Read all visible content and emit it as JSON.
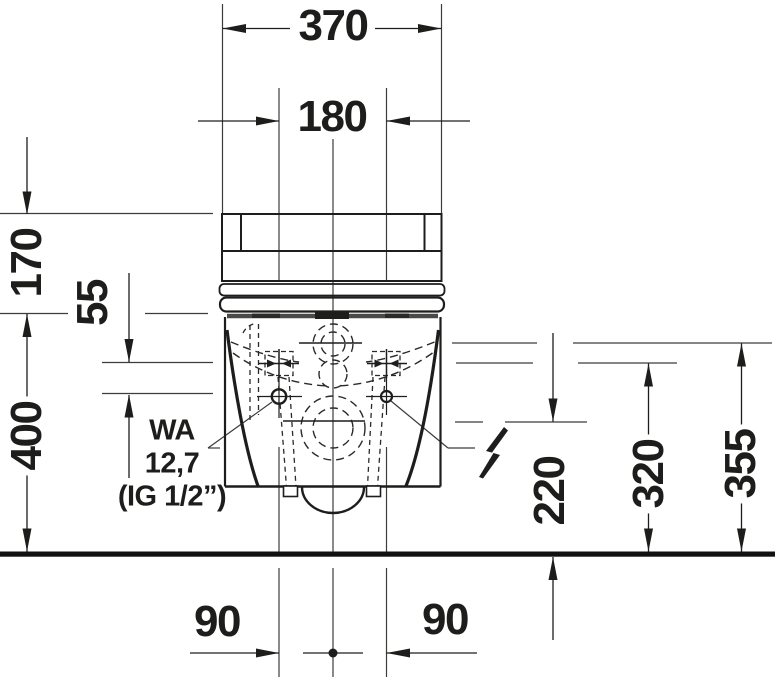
{
  "drawing": {
    "title": "Wall-hung toilet with cistern — front elevation dimension drawing",
    "units": "mm",
    "labels": {
      "d370": "370",
      "d180": "180",
      "d170": "170",
      "d55": "55",
      "d400": "400",
      "d320": "320",
      "d355": "355",
      "d220": "220",
      "d90l": "90",
      "d90r": "90",
      "wa1": "WA",
      "wa2": "12,7",
      "wa3": "(IG 1/2”)"
    },
    "icons": {
      "electrical_connection": "high-voltage-icon"
    },
    "colors": {
      "line": "#1d1d1b",
      "thin_line": "#3c3c3b",
      "floor": "#111111",
      "background": "#ffffff"
    }
  }
}
